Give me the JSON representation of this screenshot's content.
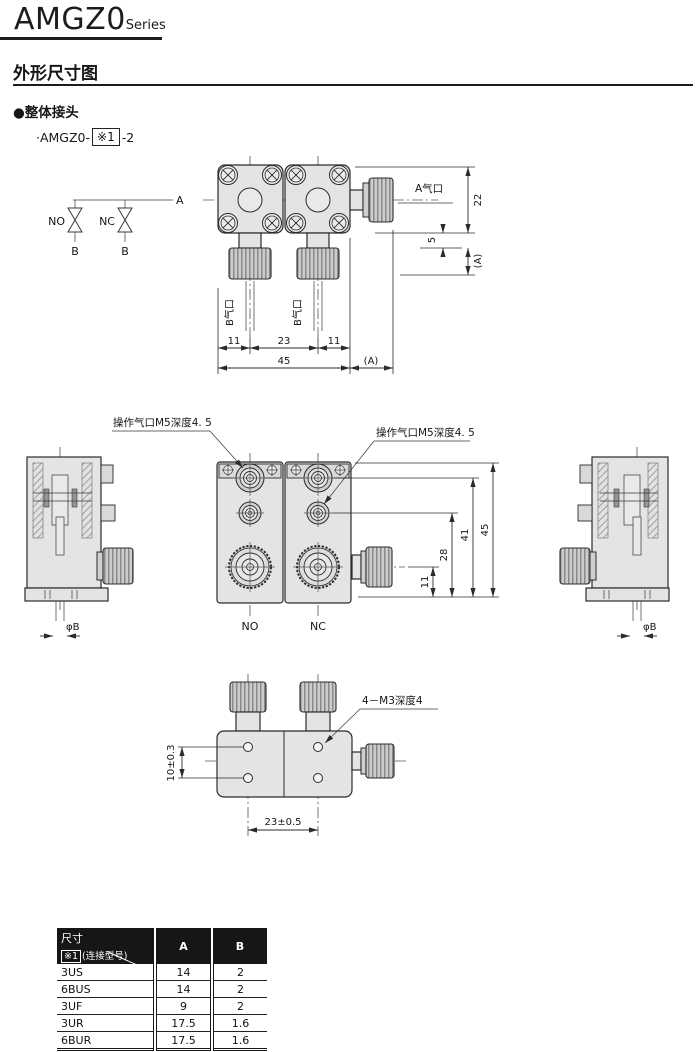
{
  "header": {
    "series_name": "AMGZ0",
    "series_suffix": "Series"
  },
  "section_title": "外形尺寸图",
  "subsection": {
    "bullet": "●整体接头",
    "model_prefix": "·AMGZ0-",
    "model_ref": "※1",
    "model_suffix": "-2"
  },
  "colors": {
    "line": "#2b2b2b",
    "body_fill": "#e4e4e4",
    "knurl_dark": "#8a8a8a",
    "table_header_bg": "#161616"
  },
  "schematic": {
    "no": "NO",
    "nc": "NC",
    "a": "A",
    "b_left": "B",
    "b_right": "B"
  },
  "top_view": {
    "port_a": "A气口",
    "port_b_left": "B气口",
    "port_b_right": "B气口",
    "dim_height": "22",
    "dim_neck": "5",
    "dim_cap": "(A)",
    "dim_11_left": "11",
    "dim_23": "23",
    "dim_11_right": "11",
    "dim_45": "45",
    "dim_a": "(A)"
  },
  "front_view": {
    "pilot_left": "操作气口M5深度4. 5",
    "pilot_right": "操作气口M5深度4. 5",
    "no": "NO",
    "nc": "NC",
    "dim_45": "45",
    "dim_41": "41",
    "dim_28": "28",
    "dim_11": "11",
    "phi_b_left": "φB",
    "phi_b_right": "φB"
  },
  "bottom_view": {
    "thread_note": "4－M3深度4",
    "dim_pitch": "23±0.5",
    "dim_height": "10±0.3"
  },
  "table": {
    "corner_title": "尺寸",
    "corner_ref": "※1",
    "corner_note": "(连接型号)",
    "col_a": "A",
    "col_b": "B",
    "rows": [
      {
        "model": "3US",
        "a": "14",
        "b": "2"
      },
      {
        "model": "6BUS",
        "a": "14",
        "b": "2"
      },
      {
        "model": "3UF",
        "a": "9",
        "b": "2"
      },
      {
        "model": "3UR",
        "a": "17.5",
        "b": "1.6"
      },
      {
        "model": "6BUR",
        "a": "17.5",
        "b": "1.6"
      }
    ]
  }
}
